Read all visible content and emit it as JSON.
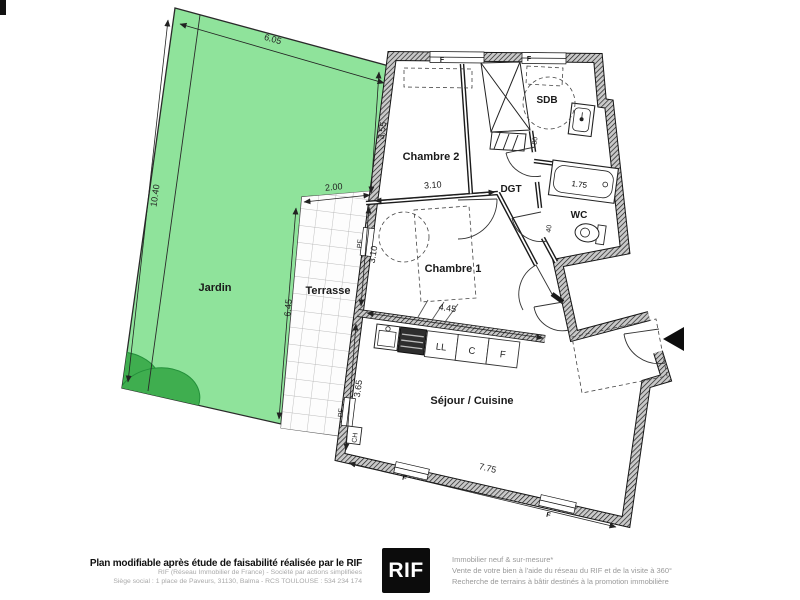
{
  "plan": {
    "rooms": {
      "jardin": "Jardin",
      "terrasse": "Terrasse",
      "chambre2": "Chambre 2",
      "chambre1": "Chambre 1",
      "sdb": "SDB",
      "dgt": "DGT",
      "wc": "WC",
      "sejour": "Séjour / Cuisine"
    },
    "dimensions": {
      "jardin_width": "6.05",
      "jardin_depth": "10.40",
      "terrasse_width": "2.00",
      "terrasse_depth": "6.45",
      "chambre2_depth": "3.55",
      "chambre2_width": "3.10",
      "chambre1_depth": "3.10",
      "chambre1_width": "4.45",
      "sejour_depth": "3.65",
      "sejour_width": "7.75",
      "baignoire": "1.75",
      "gaine": "80",
      "cloison_wc": "40"
    },
    "kitchen": {
      "lave_linge": "LL",
      "cuisson": "C",
      "frigo": "F"
    },
    "openings": {
      "fenetre": "F",
      "porte_fenetre": "PF",
      "chaudiere": "CH"
    },
    "colors": {
      "garden": "#8fe39b",
      "garden_dark": "#3fae4f",
      "line": "#111111"
    }
  },
  "footer": {
    "left": {
      "title": "Plan modifiable après étude de faisabilité réalisée par le RIF",
      "line1": "RIF (Réseau Immobilier de France) - Société par actions simplifiées",
      "line2": "Siège social : 1 place de Paveurs, 31130, Balma - RCS TOULOUSE : 534 234 174"
    },
    "logo_text": "RIF",
    "right": {
      "line1": "Immobilier neuf & sur-mesure*",
      "line2": "Vente de votre bien à l'aide du réseau du RIF et de la visite à 360°",
      "line3": "Recherche de terrains à bâtir destinés à la promotion immobilière"
    }
  }
}
